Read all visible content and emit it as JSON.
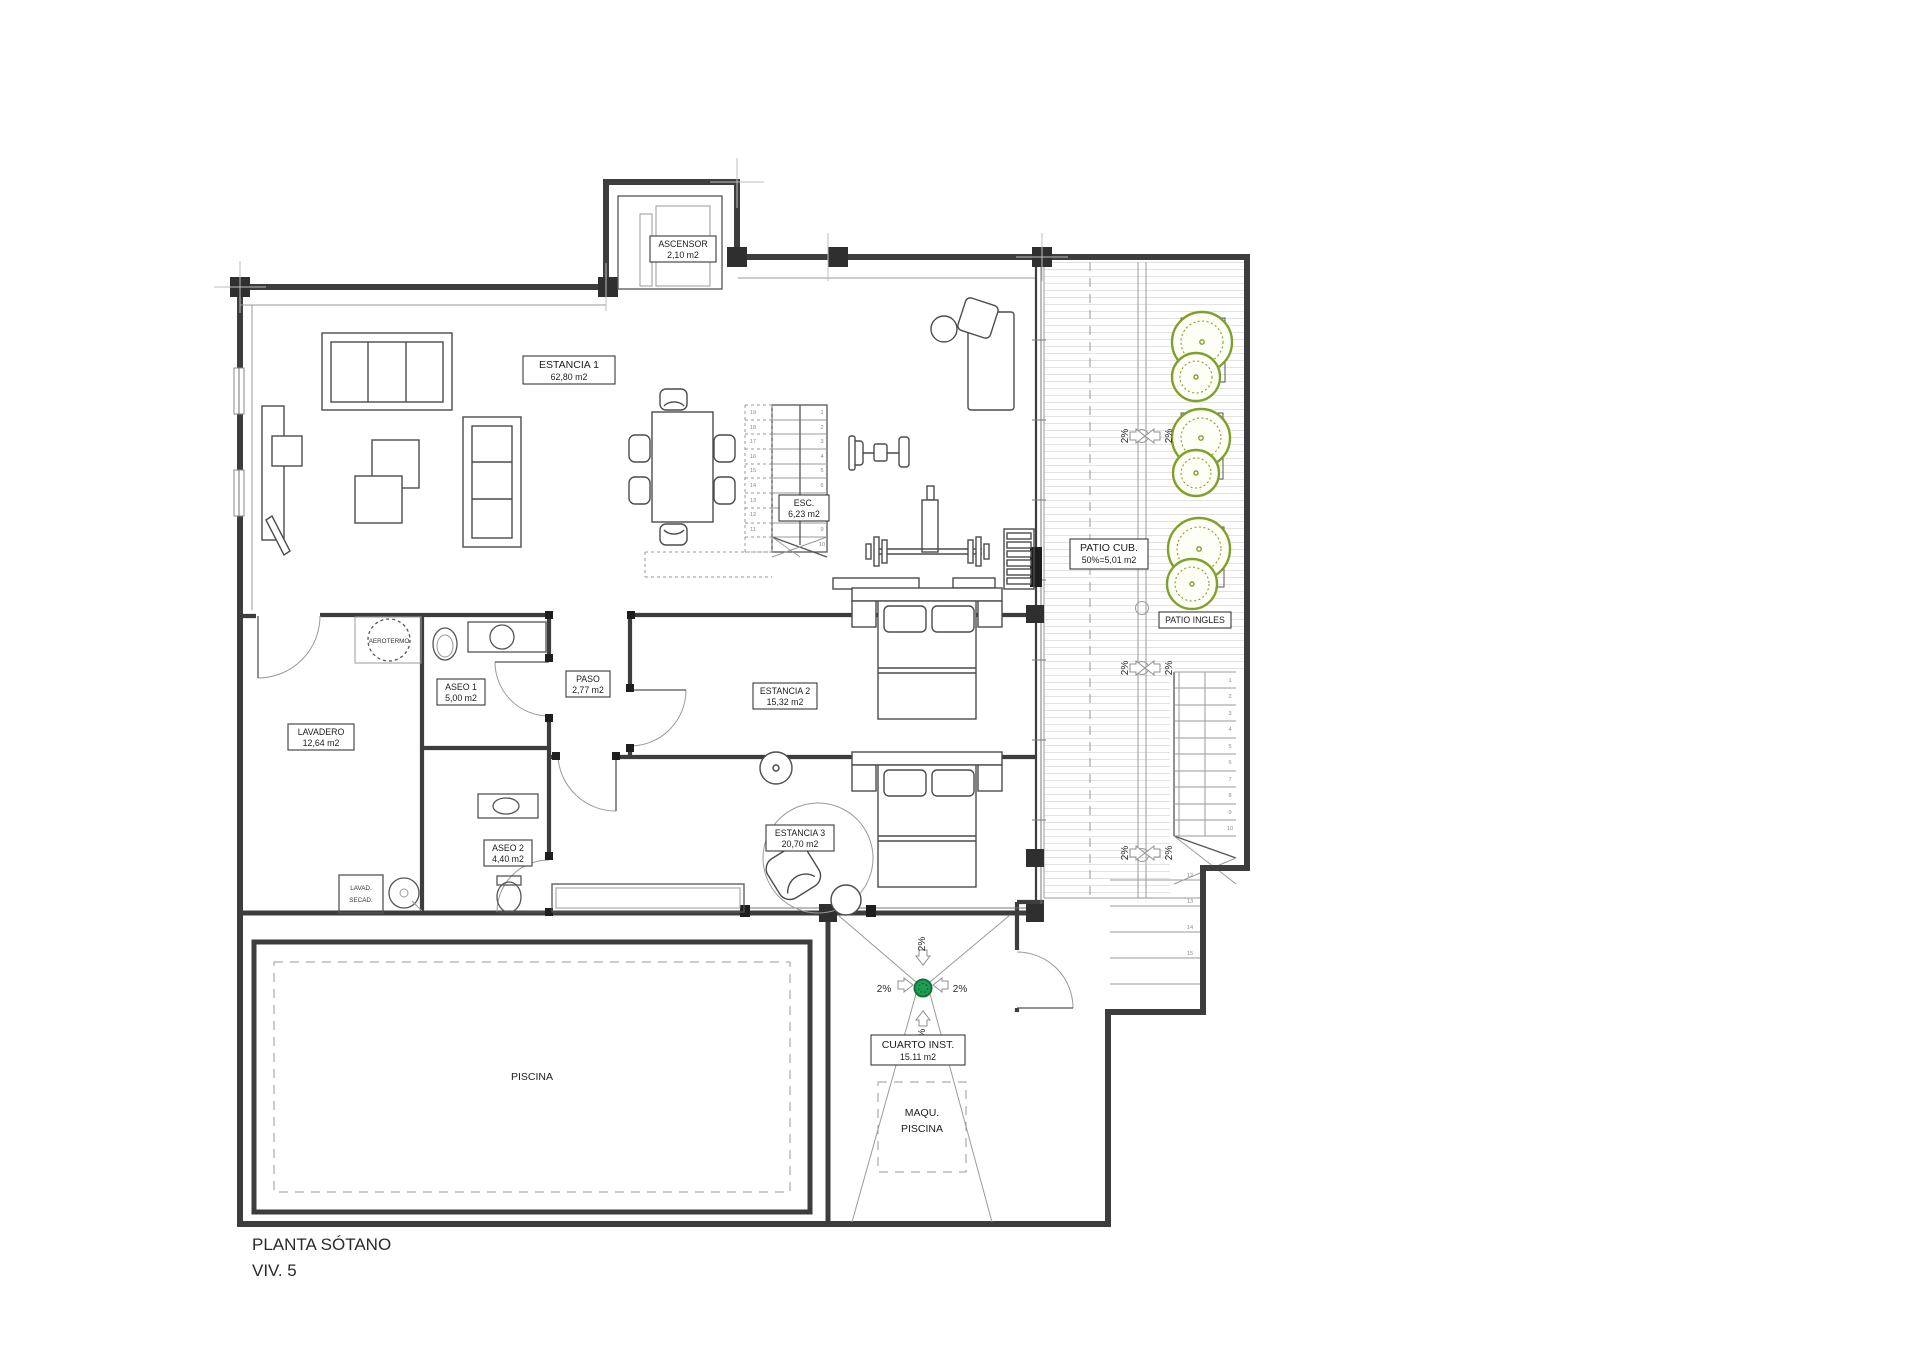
{
  "title": {
    "name": "PLANTA SÓTANO",
    "unit": "VIV. 5"
  },
  "labels": {
    "ascensor": {
      "name": "ASCENSOR",
      "area": "2,10 m2"
    },
    "estancia1": {
      "name": "ESTANCIA 1",
      "area": "62,80 m2"
    },
    "esc": {
      "name": "ESC.",
      "area": "6,23 m2"
    },
    "patio_cub": {
      "name": "PATIO CUB.",
      "area": "50%=5,01 m2"
    },
    "patio_ingles": {
      "name": "PATIO INGLES"
    },
    "aerotermo": {
      "name": "AEROTERMO"
    },
    "aseo1": {
      "name": "ASEO 1",
      "area": "5,00 m2"
    },
    "paso": {
      "name": "PASO",
      "area": "2,77 m2"
    },
    "lavadero": {
      "name": "LAVADERO",
      "area": "12,64 m2"
    },
    "estancia2": {
      "name": "ESTANCIA 2",
      "area": "15,32 m2"
    },
    "aseo2": {
      "name": "ASEO 2",
      "area": "4,40 m2"
    },
    "estancia3": {
      "name": "ESTANCIA 3",
      "area": "20,70 m2"
    },
    "lavad_secad": {
      "line1": "LAVAD.",
      "line2": "SECAD."
    },
    "piscina": {
      "name": "PISCINA"
    },
    "cuarto_inst": {
      "name": "CUARTO INST.",
      "area": "15.11 m2"
    },
    "maqu_piscina": {
      "line1": "MAQU.",
      "line2": "PISCINA"
    }
  },
  "slope_label": "2%",
  "stairs": {
    "esc_flight_down": [
      "1",
      "2",
      "3",
      "4",
      "5",
      "6",
      "7",
      "8",
      "9",
      "10"
    ],
    "esc_flight_up": [
      "19",
      "18",
      "17",
      "16",
      "15",
      "14",
      "13",
      "12",
      "11"
    ],
    "patio_upper": [
      "1",
      "2",
      "3",
      "4",
      "5",
      "6",
      "7",
      "8",
      "9",
      "10"
    ],
    "patio_lower": [
      "12",
      "13",
      "14",
      "15"
    ]
  },
  "colors": {
    "wall": "#3d3d3d",
    "tree_green": "#7fa02b",
    "drain_green": "#1e9e52",
    "hatch": "#e2e2e2"
  }
}
